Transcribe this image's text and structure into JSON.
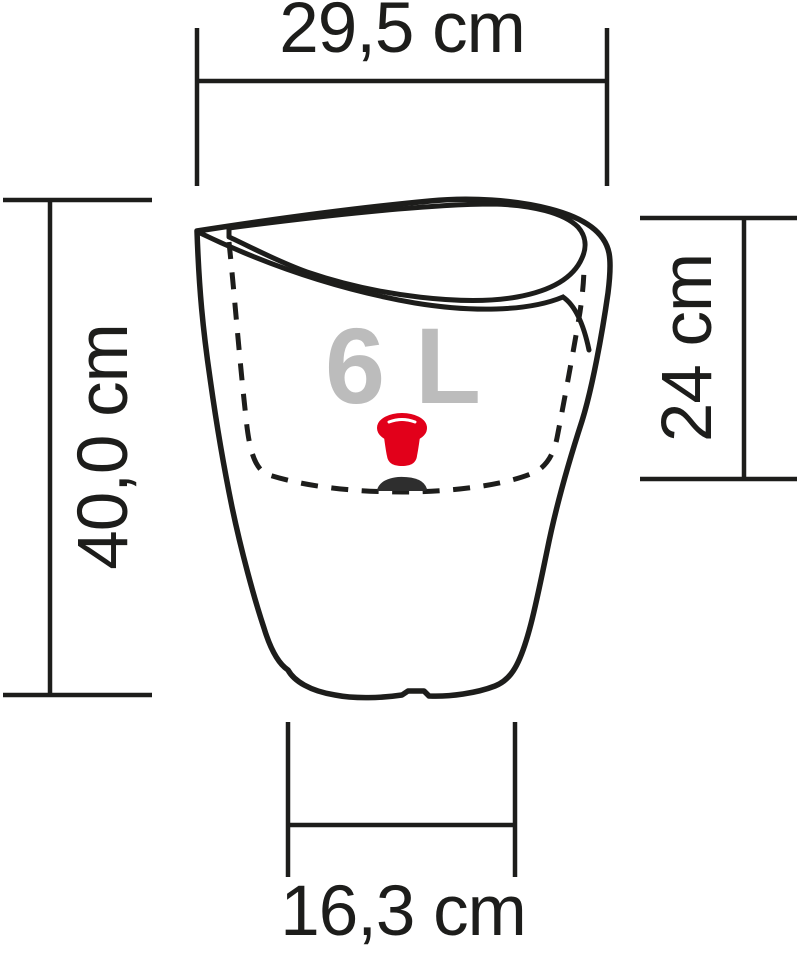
{
  "diagram": {
    "type": "product-dimension-diagram",
    "subject": "self-watering planter side view",
    "capacity_label": "6 L",
    "dimensions": {
      "top_width": "29,5 cm",
      "height": "40,0 cm",
      "inner_depth": "24 cm",
      "base_width": "16,3 cm"
    },
    "icons": {
      "water_level_indicator": "red-plug-icon",
      "ground_shadow": "dark-dome-shadow"
    },
    "colors": {
      "line": "#1d1d1b",
      "capacity_text": "#bcbcbc",
      "indicator_red": "#e2001a",
      "indicator_shadow": "#2e2e2e",
      "background": "#ffffff"
    }
  }
}
